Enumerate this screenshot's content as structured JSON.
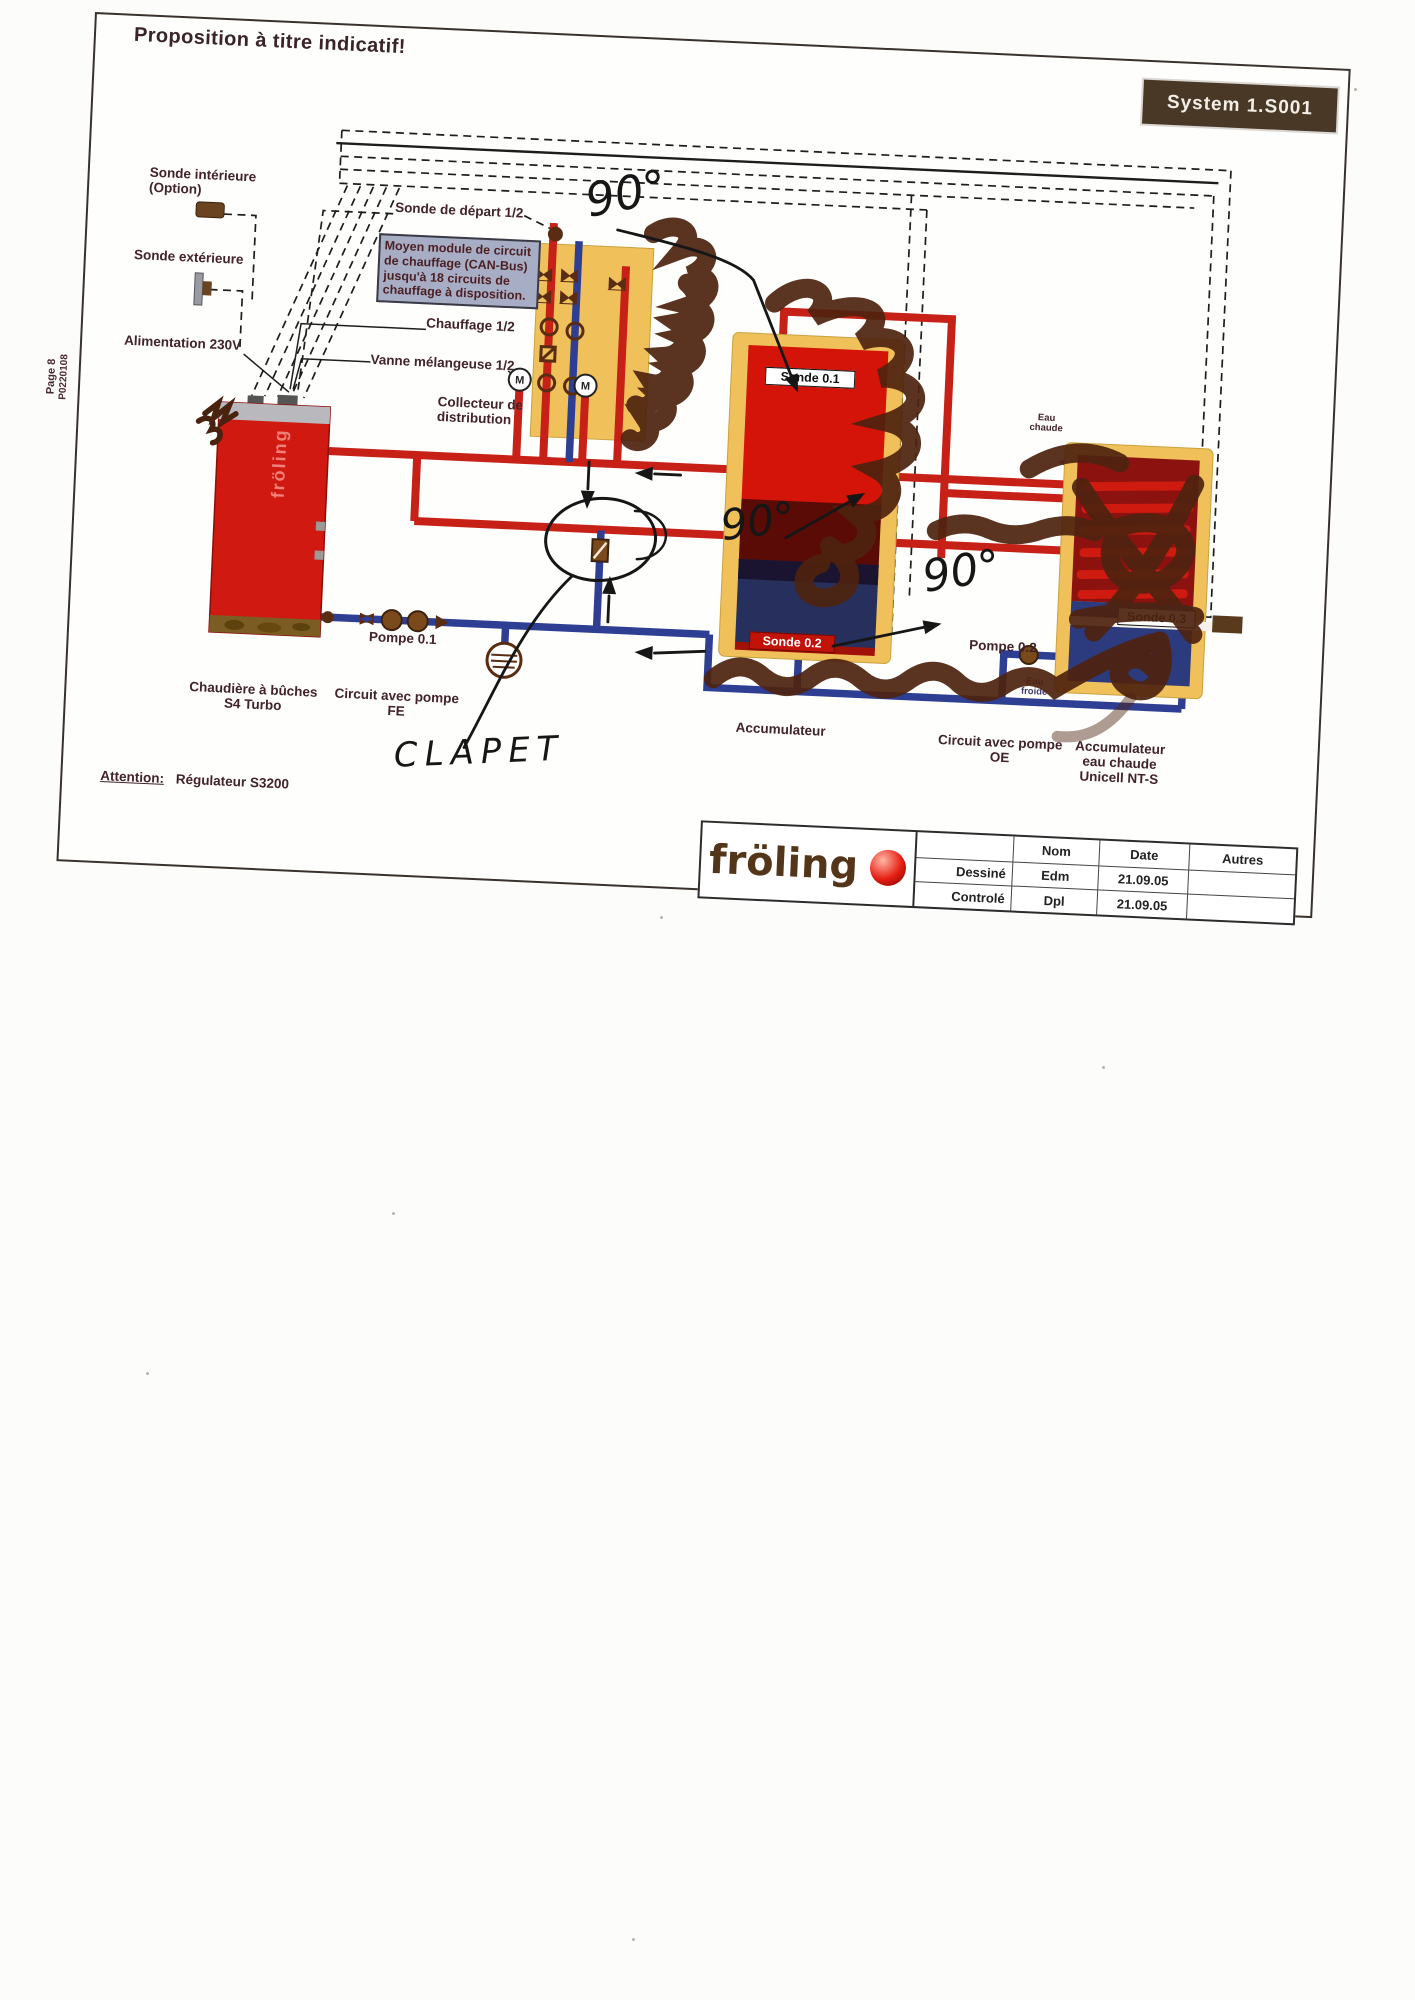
{
  "page": {
    "title": "Proposition à titre indicatif!",
    "system_label": "System 1.S001",
    "margin_line1": "Page 8",
    "margin_line2": "P0220108"
  },
  "labels": {
    "sonde_interieure_l1": "Sonde intérieure",
    "sonde_interieure_l2": "(Option)",
    "sonde_exterieure": "Sonde extérieure",
    "alimentation": "Alimentation 230V",
    "sonde_depart": "Sonde de départ 1/2",
    "module_box": "Moyen module de circuit de chauffage (CAN-Bus) jusqu'à 18 circuits de chauffage à disposition.",
    "chauffage": "Chauffage 1/2",
    "vanne": "Vanne mélangeuse 1/2",
    "collecteur_l1": "Collecteur de",
    "collecteur_l2": "distribution",
    "sonde01": "Sonde 0.1",
    "sonde02": "Sonde 0.2",
    "sonde03": "Sonde 0.3",
    "pompe01": "Pompe 0.1",
    "pompe02": "Pompe 0.2",
    "chaudiere_l1": "Chaudière à bûches",
    "chaudiere_l2": "S4 Turbo",
    "circuit_fe_l1": "Circuit avec pompe",
    "circuit_fe_l2": "FE",
    "accumulateur": "Accumulateur",
    "circuit_oe_l1": "Circuit avec pompe",
    "circuit_oe_l2": "OE",
    "acc_ec_l1": "Accumulateur",
    "acc_ec_l2": "eau chaude",
    "acc_ec_l3": "Unicell NT-S",
    "eau_chaude_l1": "Eau",
    "eau_chaude_l2": "chaude",
    "eau_froide_l1": "Eau",
    "eau_froide_l2": "froide",
    "attention": "Attention:",
    "regulateur": "Régulateur S3200",
    "boiler_brand": "fröling"
  },
  "annotations": {
    "angle1": "90°",
    "angle2": "90°",
    "angle3": "90°",
    "clapet": "CLAPET"
  },
  "titleblock": {
    "logo": "fröling",
    "col_nom": "Nom",
    "col_date": "Date",
    "col_autres": "Autres",
    "row1_label": "Dessiné",
    "row1_nom": "Edm",
    "row1_date": "21.09.05",
    "row2_label": "Controlé",
    "row2_nom": "Dpl",
    "row2_date": "21.09.05"
  },
  "colors": {
    "pipe_hot": "#c62017",
    "pipe_cold": "#2e3f93",
    "tank_yellow": "#f0c05a",
    "marker_brown": "#4e230f",
    "ink_black": "#161616",
    "label_maroon": "#42232a",
    "system_box_bg": "#4a3826"
  }
}
